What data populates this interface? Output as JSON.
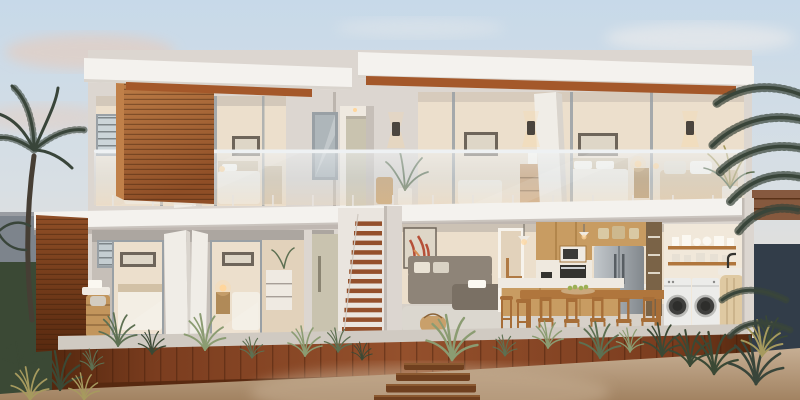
{
  "scene": {
    "aria_label": "Dusk photorealistic cutaway render of a two-storey coastal home: timber-clad facade, continuous glass balcony balustrade, open interiors showing bedrooms upstairs and living, kitchen, dining and laundry downstairs, fronted by a timber deck, sleeper path, palms and native grasses",
    "time_of_day": "dusk",
    "render_type": "architectural exterior cutaway"
  },
  "building": {
    "storeys": 2,
    "upper_rooms": [
      "bedroom",
      "bedroom",
      "bedroom",
      "bedroom",
      "lounge"
    ],
    "ground_rooms": [
      "bedroom",
      "bedroom",
      "bedroom",
      "stairwell-entry",
      "living-room",
      "kitchen-dining",
      "laundry"
    ],
    "features": [
      "glass-balustrade",
      "timber-cladding",
      "external-stair",
      "flat-roof",
      "wall-sconces-lit"
    ]
  },
  "landscape": [
    "palm-left",
    "palm-right",
    "agave-clumps",
    "native-grasses",
    "timber-deck",
    "sleeper-path",
    "sand-garden"
  ],
  "colors": {
    "sky_top": "#c7d9e9",
    "sky_mid": "#d8dfe4",
    "sky_horizon": "#eedfd0",
    "cloud_pink": "#eac9b6",
    "cloud_white": "#f4f0ec",
    "far_wall_left": "#7d848c",
    "far_wall_right": "#323d49",
    "fence_rust": "#7c4a2c",
    "hedge_dark": "#3b4935",
    "fascia": "#f4f2ee",
    "fascia_shade": "#d9d4cd",
    "soffit_wood": "#a4582a",
    "wood_light": "#c08049",
    "wood_mid": "#8f4e26",
    "wood_dark": "#58290f",
    "stucco": "#dcd6d0",
    "stucco_shade": "#c6bfb8",
    "stucco_dark": "#a79f98",
    "glass_frame": "#99a0a5",
    "glass_tint": "#d9e0e5",
    "glass_warm": "#e8d9c4",
    "rail_steel": "#eef1f3",
    "room_warm": "#ecdfcc",
    "room_warm2": "#e2d2bb",
    "bed_white": "#f3eee4",
    "headboard": "#d2c1a6",
    "pillow": "#fbf8f1",
    "frame_dark": "#6e655a",
    "art_paper": "#ded6c7",
    "lamp_glow": "#ffd69c",
    "sconce_dark": "#4b453e",
    "door_white": "#f0ede7",
    "door_beige": "#c9c3af",
    "door_handle": "#8a8472",
    "interior_floor": "#d7d1c9",
    "porch_concrete": "#d0cac2",
    "sofa_grey": "#8e8478",
    "sofa_dark": "#7a7064",
    "cushion": "#e9e2d4",
    "rug": "#dbd7d0",
    "oak": "#c89c62",
    "oak_dark": "#a5783f",
    "counter_white": "#efeae2",
    "fridge_light": "#c2c7cb",
    "fridge_dark": "#82888d",
    "appliance_dark": "#34332f",
    "steel_trim": "#cfd2d4",
    "table_wood": "#b0763d",
    "chair_wood": "#a76e38",
    "washer_white": "#ececea",
    "washer_rim": "#bcbcb9",
    "washer_door": "#3f3f3d",
    "deck_light": "#94502c",
    "deck_mid": "#7b3d1f",
    "deck_dark": "#55280f",
    "sand_light": "#c6ae93",
    "sand_dark": "#a28362",
    "sleeper": "#70401f",
    "sleeper_hi": "#8c5a31",
    "agave": "#8b9c72",
    "agave_dark": "#5d7052",
    "shrub_dark": "#3b4935",
    "palm_dark": "#39453a",
    "palm_gold": "#a69a5e",
    "trunk": "#463e34",
    "fruit_green": "#9cb054",
    "art_red": "#b65038",
    "art_orange": "#d98e52",
    "laundry_warm": "#f1e8da",
    "basket_tan": "#c9a06b",
    "wicker": "#c2955c"
  }
}
